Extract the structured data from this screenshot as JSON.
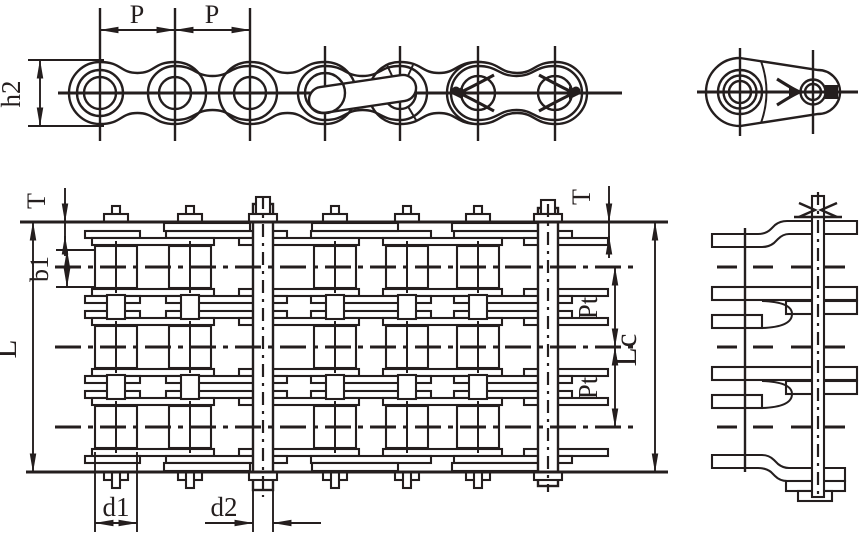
{
  "figure": {
    "colors": {
      "ink": "#241e1e",
      "paper": "#ffffff"
    },
    "labels": {
      "p1": "P",
      "p2": "P",
      "h2": "h2",
      "t_left": "T",
      "t_right": "T",
      "b1": "b1",
      "L": "L",
      "Lc": "Lc",
      "pt_upper": "Pt",
      "pt_lower": "Pt",
      "d1": "d1",
      "d2": "d2"
    }
  }
}
